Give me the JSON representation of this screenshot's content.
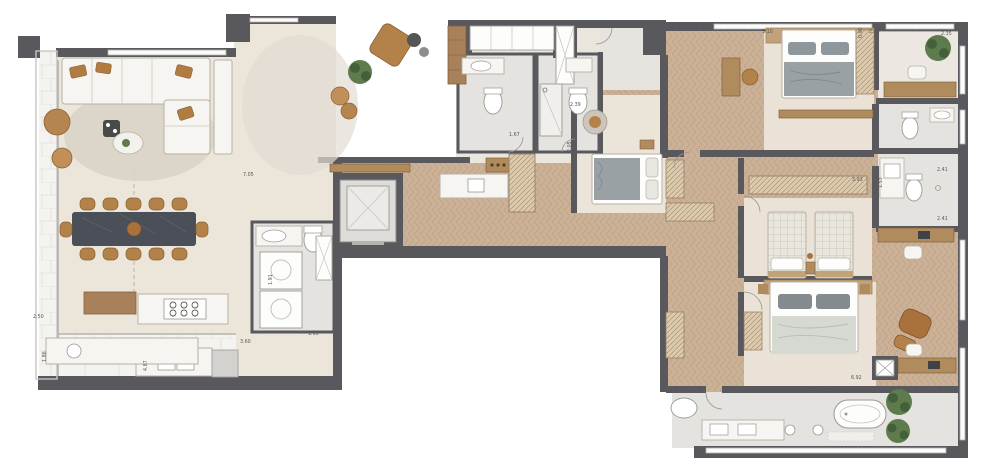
{
  "plan": {
    "type": "apartment-floor-plan",
    "palette": {
      "wall": "#59585c",
      "floor_cream": "#ece5da",
      "floor_wood": "#cbb197",
      "wood_line": "#b4936f",
      "tile": "#e5e3df",
      "terrace": "#f4f3f0",
      "furniture_white": "#f7f5f1",
      "furniture_stroke": "#b7b1a6",
      "accent_wood": "#b07c42",
      "marble_table": "#4b5058",
      "plant_green": "#5d7b4c",
      "blanket_gray": "#99a1a5",
      "dim_text": "#57565a"
    },
    "dims": [
      {
        "id": "living-width",
        "text": "7.05"
      },
      {
        "id": "kitchen-terrace-width",
        "text": "2.50"
      },
      {
        "id": "terrace-depth",
        "text": "1.86"
      },
      {
        "id": "kitchen-length",
        "text": "4.87"
      },
      {
        "id": "kitchen-width",
        "text": "3.60"
      },
      {
        "id": "laundry-width",
        "text": "1.05"
      },
      {
        "id": "laundry-depth",
        "text": "1.91"
      },
      {
        "id": "shower-room-width",
        "text": "1.67"
      },
      {
        "id": "hall-width",
        "text": "2.39"
      },
      {
        "id": "hall-depth",
        "text": "2.05"
      },
      {
        "id": "bedroom1-width",
        "text": "3.10"
      },
      {
        "id": "bedroom2-width",
        "text": "2.35"
      },
      {
        "id": "office-width",
        "text": "2.35"
      },
      {
        "id": "bath-top-width",
        "text": "3.93"
      },
      {
        "id": "bath-top-depth",
        "text": "1.53"
      },
      {
        "id": "bath-right-width-a",
        "text": "2.41"
      },
      {
        "id": "bath-right-width-b",
        "text": "2.41"
      },
      {
        "id": "master-bath-width-a",
        "text": "4.93"
      },
      {
        "id": "master-bath-width-b",
        "text": "2.44"
      },
      {
        "id": "master-suite-width",
        "text": "6.92"
      },
      {
        "id": "closet-depth",
        "text": "0.90"
      }
    ]
  }
}
